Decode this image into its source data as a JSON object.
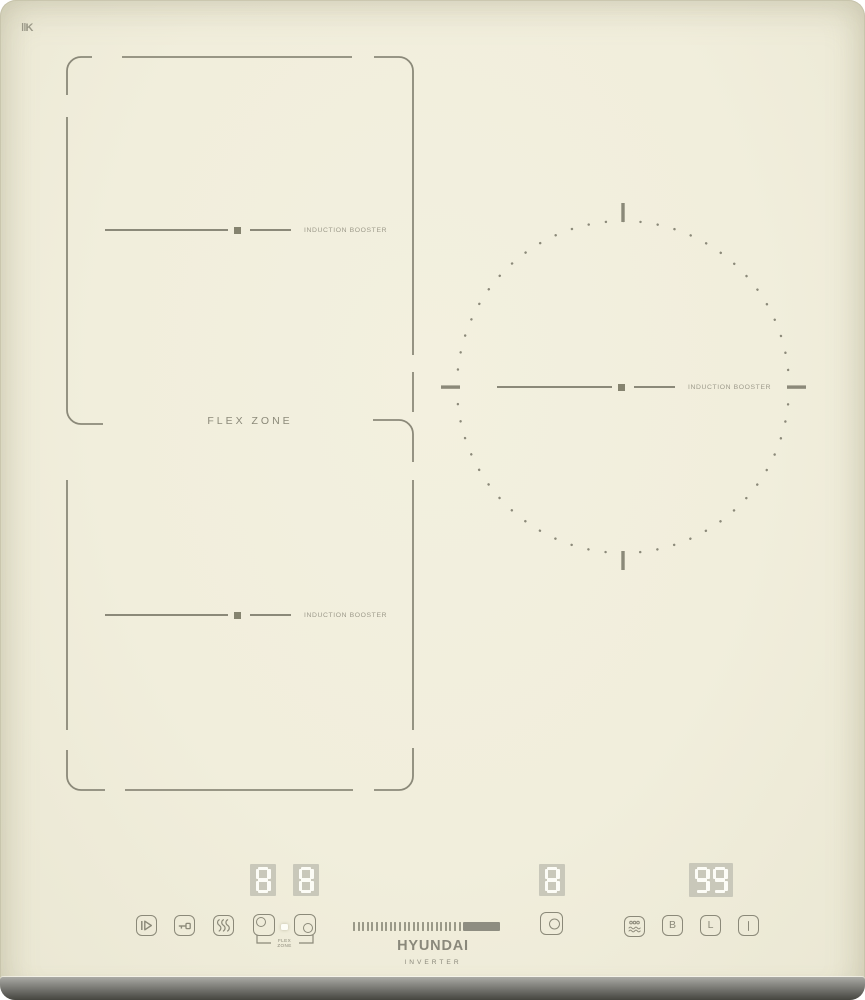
{
  "device": {
    "brand": "HYUNDAI",
    "series": "INVERTER",
    "surface_mark": "‖K"
  },
  "zones": {
    "flex_label": "FLEX ZONE",
    "booster_top_label": "INDUCTION BOOSTER",
    "booster_bottom_label": "INDUCTION BOOSTER",
    "booster_right_label": "INDUCTION BOOSTER"
  },
  "displays": {
    "flex_top": "8",
    "flex_bottom": "8",
    "right_zone": "8",
    "timer": "99"
  },
  "controls": {
    "icons": {
      "pause": "pause-icon",
      "key_lock": "key-lock-icon",
      "keep_warm": "keep-warm-icon",
      "select_top_zone": "zone-circle-top-left-icon",
      "select_bottom_zone": "zone-circle-bottom-right-icon",
      "select_right_zone": "zone-circle-right-icon",
      "boil": "boil-icon"
    },
    "flex_link_label_1": "FLEX",
    "flex_link_label_2": "ZONE",
    "booster_key": "B",
    "lock_key": "L",
    "power_key": "I",
    "slider": {
      "ticks": 24,
      "filled": true
    }
  },
  "colors": {
    "surface": "#f1eedc",
    "line": "#8b8979",
    "label": "#9d9a8b",
    "display_panel": "#c9c8ba",
    "digit": "#fcfcf6",
    "trim_dark": "#45453f"
  }
}
